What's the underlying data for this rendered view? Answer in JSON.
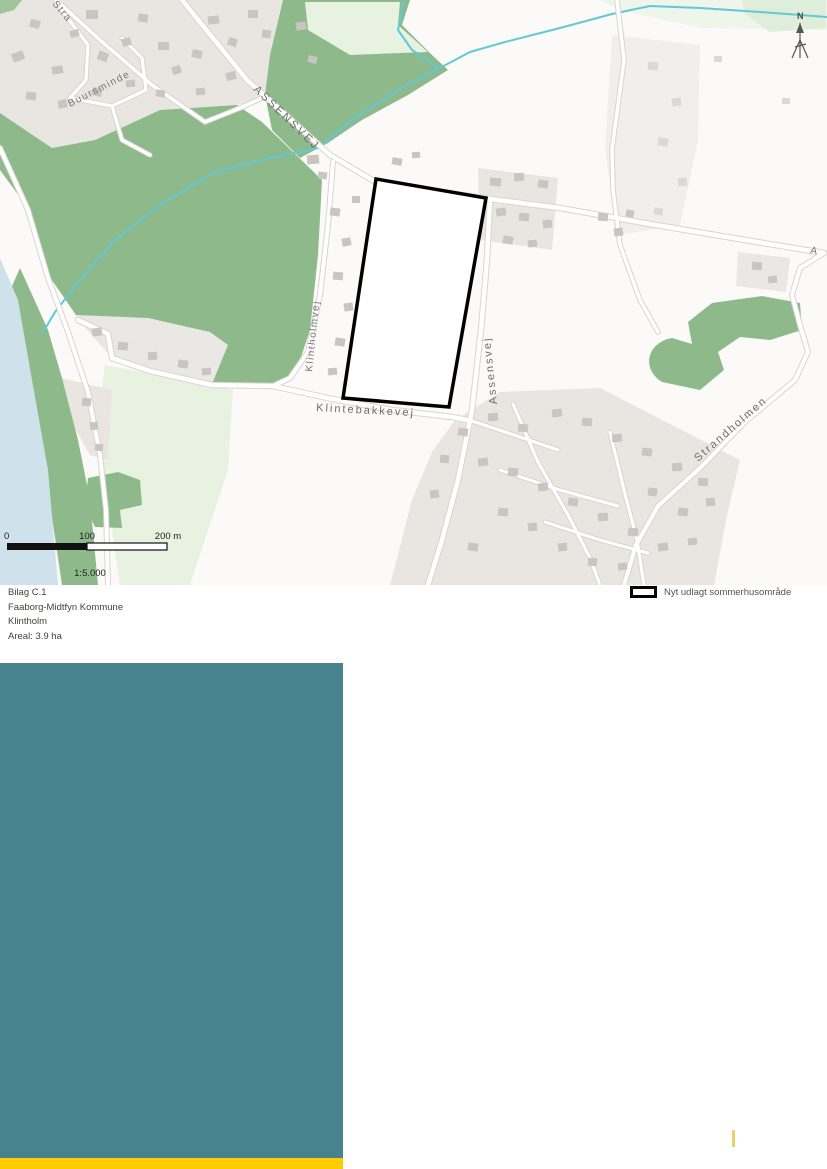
{
  "map": {
    "road_labels": {
      "assensvej_caps": "ASSENSVEJ",
      "assensvej": "Assensvej",
      "klintholmvej": "Klintholmvej",
      "klintebakkevej": "Klintebakkevej",
      "strandholmen": "Strandholmen",
      "buursminde": "Buursminde"
    },
    "partial_labels": {
      "stra": "Stra",
      "a": "A"
    },
    "north_indicator": "N",
    "scale_bar": {
      "tick_start": "0",
      "tick_mid": "100",
      "tick_end": "200 m",
      "scale_ratio": "1:5.000"
    }
  },
  "info_block": {
    "attachment": "Bilag C.1",
    "municipality": "Faaborg-Midtfyn Kommune",
    "site_name": "Klintholm",
    "area": "Areal: 3.9 ha"
  },
  "legend": {
    "new_summerhouse_area": "Nyt udlagt sommerhusområde"
  },
  "colors": {
    "site_outline": "#000000",
    "forest_green": "#8eba8b",
    "pale_green": "#e7f2e1",
    "water_blue": "#cfe1ea",
    "stream_cyan": "#62c8d6",
    "urban_gray": "#e9e6e2",
    "teal_block": "#47828f",
    "yellow_bar": "#ffcc00"
  }
}
